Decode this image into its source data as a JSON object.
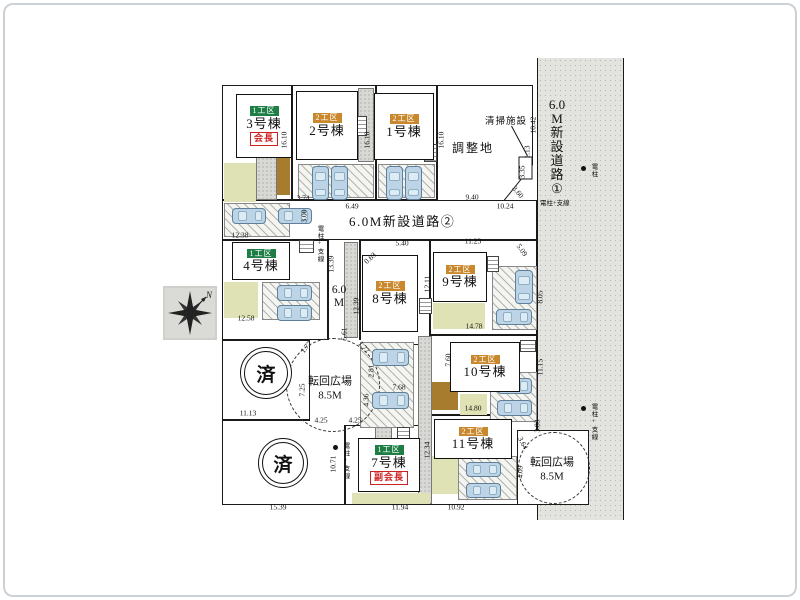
{
  "plan": {
    "roads": {
      "road2": "6.0M新設道路②",
      "road1_chars": [
        "6.0",
        "M",
        "新",
        "設",
        "道",
        "路",
        "①"
      ],
      "road3_chars": [
        "6.0",
        "M"
      ]
    },
    "chosei_label": "調整地",
    "seiso_label": "清掃施設",
    "sold_label": "済",
    "compass_label": "N",
    "zones": {
      "z1": {
        "label": "1工区",
        "color": "#1e7e45"
      },
      "z2": {
        "label": "2工区",
        "color": "#c8882b"
      }
    },
    "buildings": [
      {
        "name": "1号棟",
        "z": "z2",
        "x": 374,
        "y": 93,
        "w": 60,
        "h": 67
      },
      {
        "name": "2号棟",
        "z": "z2",
        "x": 296,
        "y": 91,
        "w": 62,
        "h": 69
      },
      {
        "name": "3号棟",
        "z": "z1",
        "tag": "会長",
        "x": 236,
        "y": 94,
        "w": 56,
        "h": 64
      },
      {
        "name": "4号棟",
        "z": "z1",
        "x": 232,
        "y": 242,
        "w": 58,
        "h": 38
      },
      {
        "name": "7号棟",
        "z": "z1",
        "tag": "副会長",
        "x": 358,
        "y": 438,
        "w": 62,
        "h": 54
      },
      {
        "name": "8号棟",
        "z": "z2",
        "x": 362,
        "y": 255,
        "w": 56,
        "h": 77
      },
      {
        "name": "9号棟",
        "z": "z2",
        "x": 433,
        "y": 252,
        "w": 54,
        "h": 50
      },
      {
        "name": "10号棟",
        "z": "z2",
        "x": 450,
        "y": 342,
        "w": 70,
        "h": 50
      },
      {
        "name": "11号棟",
        "z": "z2",
        "x": 434,
        "y": 419,
        "w": 78,
        "h": 40
      }
    ],
    "turnarounds": [
      {
        "label": "転回広場",
        "size": "8.5M",
        "cx": 332,
        "cy": 384,
        "r": 46,
        "lx": 330,
        "ly": 389
      },
      {
        "label": "転回広場",
        "size": "8.5M",
        "cx": 553,
        "cy": 467,
        "r": 35,
        "lx": 552,
        "ly": 470
      }
    ],
    "sold_circles": [
      {
        "x": 240,
        "y": 347,
        "d": 50
      },
      {
        "x": 258,
        "y": 438,
        "d": 48
      }
    ],
    "poles": [
      {
        "label": "電柱",
        "x": 588,
        "y": 166,
        "dot": true,
        "v": true
      },
      {
        "label": "電柱+支線",
        "x": 588,
        "y": 406,
        "dot": true,
        "v": true
      },
      {
        "label": "電柱+支線",
        "x": 314,
        "y": 228,
        "dot": false,
        "v": true
      },
      {
        "label": "電柱+支線",
        "x": 340,
        "y": 445,
        "dot": true,
        "v": true
      },
      {
        "label": "電柱+支線",
        "x": 540,
        "y": 200,
        "dot": false,
        "v": false
      }
    ],
    "dims": [
      {
        "t": "16.10",
        "x": 284,
        "y": 140,
        "v": true
      },
      {
        "t": "16.10",
        "x": 367,
        "y": 140,
        "v": true
      },
      {
        "t": "16.10",
        "x": 441,
        "y": 140,
        "v": true
      },
      {
        "t": "10.42",
        "x": 533,
        "y": 125,
        "v": true
      },
      {
        "t": "1.13",
        "x": 527,
        "y": 152,
        "v": true
      },
      {
        "t": "3.35",
        "x": 522,
        "y": 172,
        "v": true
      },
      {
        "t": "3.60",
        "x": 518,
        "y": 192,
        "r": 50
      },
      {
        "t": "9.40",
        "x": 472,
        "y": 197
      },
      {
        "t": "3.74",
        "x": 303,
        "y": 198
      },
      {
        "t": "6.49",
        "x": 352,
        "y": 206
      },
      {
        "t": "10.24",
        "x": 505,
        "y": 206
      },
      {
        "t": "12.38",
        "x": 240,
        "y": 235
      },
      {
        "t": "5.40",
        "x": 402,
        "y": 243
      },
      {
        "t": "11.23",
        "x": 473,
        "y": 241
      },
      {
        "t": "5.09",
        "x": 522,
        "y": 250,
        "r": 55
      },
      {
        "t": "0.63",
        "x": 370,
        "y": 258,
        "r": -42
      },
      {
        "t": "3.00",
        "x": 304,
        "y": 216,
        "v": true
      },
      {
        "t": "13.39",
        "x": 331,
        "y": 264,
        "v": true
      },
      {
        "t": "12.39",
        "x": 356,
        "y": 306,
        "v": true
      },
      {
        "t": "12.58",
        "x": 246,
        "y": 318
      },
      {
        "t": "12.11",
        "x": 427,
        "y": 284,
        "v": true
      },
      {
        "t": "14.78",
        "x": 474,
        "y": 326
      },
      {
        "t": "8.05",
        "x": 540,
        "y": 297,
        "v": true
      },
      {
        "t": "11.15",
        "x": 540,
        "y": 367,
        "v": true
      },
      {
        "t": "5.61",
        "x": 344,
        "y": 334,
        "v": true
      },
      {
        "t": "1.77",
        "x": 306,
        "y": 347,
        "r": -50
      },
      {
        "t": "1.77",
        "x": 364,
        "y": 347,
        "r": 50
      },
      {
        "t": "7.25",
        "x": 302,
        "y": 390,
        "v": true
      },
      {
        "t": "2.81",
        "x": 371,
        "y": 371,
        "v": true
      },
      {
        "t": "4.36",
        "x": 366,
        "y": 400,
        "v": true
      },
      {
        "t": "7.68",
        "x": 399,
        "y": 387
      },
      {
        "t": "4.25",
        "x": 321,
        "y": 420
      },
      {
        "t": "4.25",
        "x": 355,
        "y": 420
      },
      {
        "t": "11.13",
        "x": 248,
        "y": 413
      },
      {
        "t": "14.80",
        "x": 473,
        "y": 408
      },
      {
        "t": "7.60",
        "x": 448,
        "y": 360,
        "v": true
      },
      {
        "t": "3.83",
        "x": 537,
        "y": 426,
        "v": true
      },
      {
        "t": "3.64",
        "x": 523,
        "y": 443,
        "r": 62
      },
      {
        "t": "4.09",
        "x": 520,
        "y": 472,
        "v": true
      },
      {
        "t": "10.71",
        "x": 333,
        "y": 464,
        "v": true
      },
      {
        "t": "12.34",
        "x": 427,
        "y": 450,
        "v": true
      },
      {
        "t": "15.39",
        "x": 278,
        "y": 507
      },
      {
        "t": "11.94",
        "x": 400,
        "y": 507
      },
      {
        "t": "10.92",
        "x": 456,
        "y": 507
      }
    ],
    "lots": [
      {
        "x": 222,
        "y": 85,
        "w": 70,
        "h": 115,
        "b": "all"
      },
      {
        "x": 292,
        "y": 85,
        "w": 84,
        "h": 115,
        "b": "all"
      },
      {
        "x": 376,
        "y": 85,
        "w": 61,
        "h": 115,
        "b": "all"
      },
      {
        "x": 222,
        "y": 200,
        "w": 315,
        "h": 40,
        "b": "all"
      },
      {
        "x": 222,
        "y": 240,
        "w": 106,
        "h": 100,
        "b": "all"
      },
      {
        "x": 328,
        "y": 240,
        "w": 32,
        "h": 100,
        "b": "lr"
      },
      {
        "x": 360,
        "y": 240,
        "w": 70,
        "h": 105,
        "b": "all"
      },
      {
        "x": 430,
        "y": 240,
        "w": 107,
        "h": 95,
        "b": "all"
      },
      {
        "x": 430,
        "y": 335,
        "w": 107,
        "h": 80,
        "b": "all"
      },
      {
        "x": 430,
        "y": 415,
        "w": 107,
        "h": 90,
        "b": "all"
      },
      {
        "x": 345,
        "y": 425,
        "w": 85,
        "h": 80,
        "b": "all"
      },
      {
        "x": 222,
        "y": 340,
        "w": 88,
        "h": 80,
        "b": "all"
      },
      {
        "x": 222,
        "y": 420,
        "w": 123,
        "h": 85,
        "b": "all"
      },
      {
        "x": 310,
        "y": 340,
        "w": 68,
        "h": 85,
        "b": "n"
      },
      {
        "x": 517,
        "y": 430,
        "w": 72,
        "h": 75,
        "b": "all"
      }
    ],
    "patches": [
      {
        "t": "stipple",
        "x": 256,
        "y": 152,
        "w": 21,
        "h": 48
      },
      {
        "t": "stipple",
        "x": 358,
        "y": 88,
        "w": 16,
        "h": 74
      },
      {
        "t": "stipple",
        "x": 437,
        "y": 162,
        "w": 17,
        "h": 38
      },
      {
        "t": "stipple",
        "x": 344,
        "y": 242,
        "w": 14,
        "h": 96
      },
      {
        "t": "stipple",
        "x": 418,
        "y": 336,
        "w": 14,
        "h": 168
      },
      {
        "t": "stipple",
        "x": 375,
        "y": 425,
        "w": 17,
        "h": 58
      },
      {
        "t": "olive",
        "x": 224,
        "y": 163,
        "w": 32,
        "h": 39
      },
      {
        "t": "olive",
        "x": 224,
        "y": 282,
        "w": 34,
        "h": 36
      },
      {
        "t": "olive",
        "x": 433,
        "y": 303,
        "w": 52,
        "h": 26
      },
      {
        "t": "olive",
        "x": 460,
        "y": 394,
        "w": 27,
        "h": 21
      },
      {
        "t": "olive",
        "x": 432,
        "y": 456,
        "w": 26,
        "h": 38
      },
      {
        "t": "olive",
        "x": 352,
        "y": 493,
        "w": 78,
        "h": 11
      },
      {
        "t": "brown",
        "x": 277,
        "y": 155,
        "w": 13,
        "h": 40
      },
      {
        "t": "brown",
        "x": 432,
        "y": 382,
        "w": 26,
        "h": 28
      },
      {
        "t": "hatch",
        "x": 224,
        "y": 203,
        "w": 66,
        "h": 34
      },
      {
        "t": "hatch",
        "x": 298,
        "y": 164,
        "w": 76,
        "h": 34
      },
      {
        "t": "hatch",
        "x": 378,
        "y": 164,
        "w": 57,
        "h": 34
      },
      {
        "t": "hatch",
        "x": 262,
        "y": 282,
        "w": 58,
        "h": 38
      },
      {
        "t": "hatch",
        "x": 360,
        "y": 342,
        "w": 54,
        "h": 86
      },
      {
        "t": "hatch",
        "x": 492,
        "y": 266,
        "w": 45,
        "h": 64
      },
      {
        "t": "hatch",
        "x": 490,
        "y": 372,
        "w": 47,
        "h": 50
      },
      {
        "t": "hatch",
        "x": 458,
        "y": 456,
        "w": 59,
        "h": 44
      }
    ],
    "steps": [
      {
        "x": 352,
        "y": 116,
        "w": 15,
        "h": 20
      },
      {
        "x": 424,
        "y": 144,
        "w": 13,
        "h": 18
      },
      {
        "x": 299,
        "y": 240,
        "w": 15,
        "h": 13
      },
      {
        "x": 419,
        "y": 298,
        "w": 13,
        "h": 16
      },
      {
        "x": 487,
        "y": 256,
        "w": 12,
        "h": 16
      },
      {
        "x": 520,
        "y": 340,
        "w": 16,
        "h": 12
      },
      {
        "x": 397,
        "y": 427,
        "w": 13,
        "h": 13
      }
    ],
    "cars": [
      {
        "x": 312,
        "y": 166,
        "w": 17,
        "h": 34,
        "o": "v"
      },
      {
        "x": 331,
        "y": 166,
        "w": 17,
        "h": 34,
        "o": "v"
      },
      {
        "x": 386,
        "y": 166,
        "w": 17,
        "h": 34,
        "o": "v"
      },
      {
        "x": 405,
        "y": 166,
        "w": 17,
        "h": 34,
        "o": "v"
      },
      {
        "x": 515,
        "y": 270,
        "w": 18,
        "h": 34,
        "o": "v"
      },
      {
        "x": 232,
        "y": 208,
        "w": 34,
        "h": 16,
        "o": "h"
      },
      {
        "x": 278,
        "y": 208,
        "w": 34,
        "h": 16,
        "o": "h"
      },
      {
        "x": 277,
        "y": 285,
        "w": 35,
        "h": 16,
        "o": "h"
      },
      {
        "x": 277,
        "y": 305,
        "w": 35,
        "h": 16,
        "o": "h"
      },
      {
        "x": 372,
        "y": 349,
        "w": 37,
        "h": 17,
        "o": "h"
      },
      {
        "x": 372,
        "y": 392,
        "w": 37,
        "h": 17,
        "o": "h"
      },
      {
        "x": 496,
        "y": 309,
        "w": 36,
        "h": 16,
        "o": "h"
      },
      {
        "x": 497,
        "y": 378,
        "w": 35,
        "h": 16,
        "o": "h"
      },
      {
        "x": 497,
        "y": 400,
        "w": 35,
        "h": 16,
        "o": "h"
      },
      {
        "x": 466,
        "y": 462,
        "w": 35,
        "h": 15,
        "o": "h"
      },
      {
        "x": 466,
        "y": 483,
        "w": 35,
        "h": 15,
        "o": "h"
      }
    ]
  }
}
